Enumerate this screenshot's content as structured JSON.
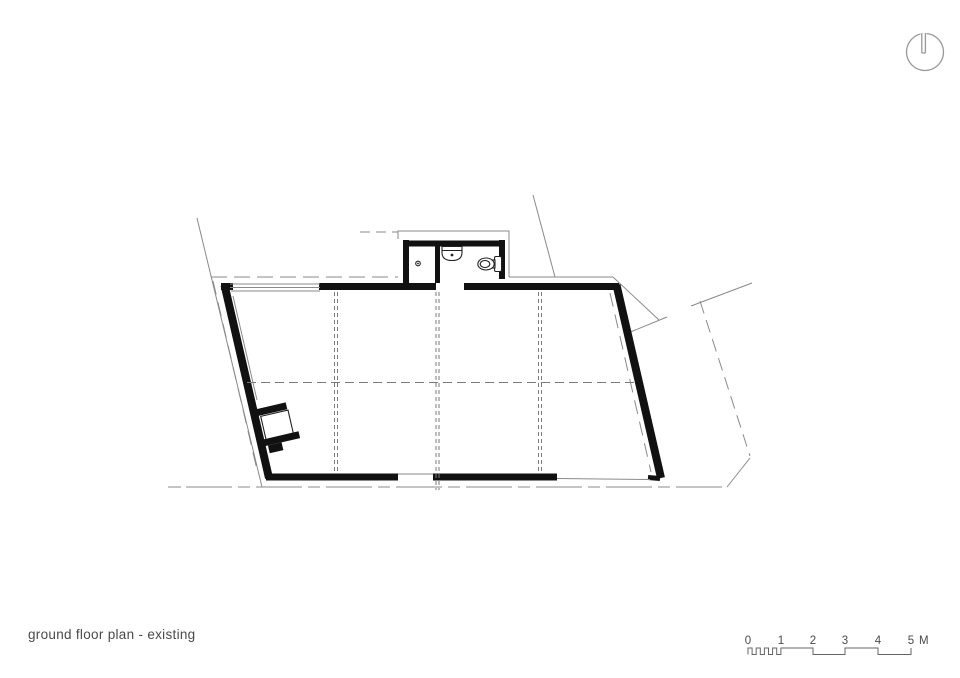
{
  "title": {
    "label": "ground floor plan - existing"
  },
  "scale_bar": {
    "labels": [
      "0",
      "1",
      "2",
      "3",
      "4",
      "5"
    ],
    "unit_label": "M"
  },
  "plan": {
    "drawing_type": "architectural floor plan",
    "building_shape": "slanted parallelogram hall with small sanitary annex at top",
    "fixtures": {
      "toilet": "toilet-fixture",
      "sink": "sink-fixture",
      "stove": "stove-fixture",
      "floor_drain": "floor-drain-dot"
    },
    "icons": {
      "north_arrow": "north-arrow-icon"
    }
  },
  "colors": {
    "background": "#ffffff",
    "walls": "#111111",
    "thin_lines": "#8a8a8a",
    "grid_dashes": "#7a7a7a",
    "fixtures": "#222222",
    "text": "#4a4a4a",
    "scale_bar": "#666666"
  }
}
